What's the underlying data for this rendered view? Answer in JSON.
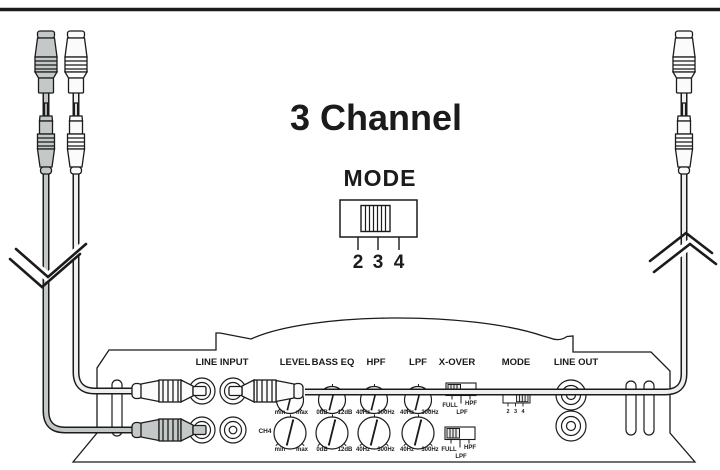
{
  "diagram_title": "3 Channel",
  "mode_selector": {
    "heading": "MODE",
    "positions": [
      "2",
      "3",
      "4"
    ],
    "selected_position": "3"
  },
  "rear_panel": {
    "labels": {
      "line_input": "LINE INPUT",
      "level": "LEVEL",
      "bass_eq": "BASS EQ",
      "hpf": "HPF",
      "lpf": "LPF",
      "xover": "X-OVER",
      "mode": "MODE",
      "line_out": "LINE OUT"
    },
    "line_input": {
      "ch4_label": "CH4"
    },
    "level_scale": {
      "min": "min",
      "max": "max"
    },
    "bass_eq_scale": {
      "min": "0dB",
      "max": "12dB"
    },
    "hpf_scale": {
      "min": "40Hz",
      "max": "300Hz"
    },
    "lpf_scale": {
      "min": "40Hz",
      "max": "300Hz"
    },
    "xover_scale": {
      "full": "FULL",
      "hpf": "HPF",
      "lpf": "LPF"
    },
    "mode_switch": {
      "positions": [
        "2",
        "3",
        "4"
      ]
    }
  },
  "colors": {
    "line_art": "#1b1b1b",
    "gray_connector": "#c5c8c8",
    "white_connector": "#fbfbfb"
  }
}
